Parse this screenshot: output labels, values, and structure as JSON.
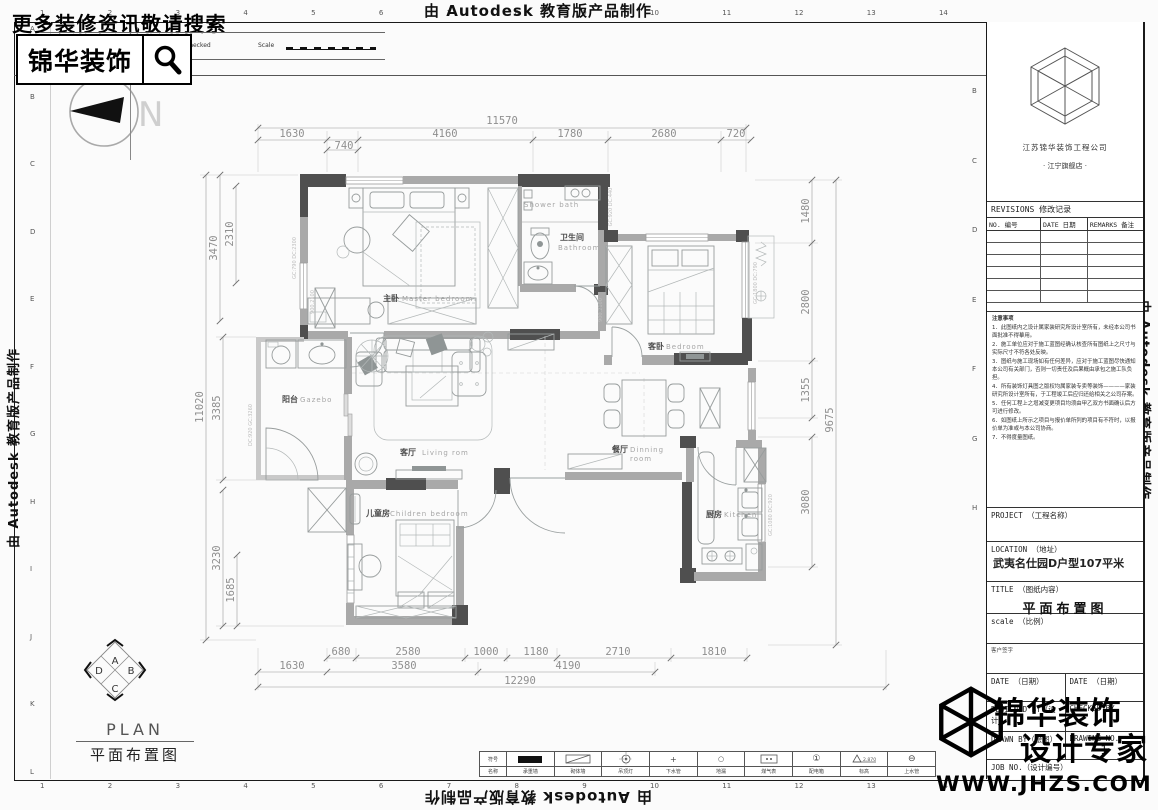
{
  "watermarks": {
    "top": "由 Autodesk 教育版产品制作",
    "bottom": "由 Autodesk 教育版产品制作",
    "left": "由 Autodesk 教育版产品制作",
    "right": "由 Autodesk 教育版产品制作"
  },
  "promo": {
    "search_hint": "更多装修资讯敬请搜索",
    "logo": "锦华装饰"
  },
  "frame_strip": {
    "rev_no": "Rev/No",
    "revision_note": "Revision note",
    "signature": "Signature",
    "checked": "Checked",
    "scale": "Scale"
  },
  "compass": {
    "north": "N"
  },
  "orientation": {
    "top": "A",
    "right": "B",
    "bottom": "C",
    "left": "D"
  },
  "plan_label": {
    "en": "PLAN",
    "zh": "平面布置图"
  },
  "ruler": {
    "top": [
      "1",
      "2",
      "3",
      "4",
      "5",
      "6",
      "7",
      "8",
      "9",
      "10",
      "11",
      "12",
      "13",
      "14"
    ],
    "bottom": [
      "1",
      "2",
      "3",
      "4",
      "5",
      "6",
      "7",
      "8",
      "9",
      "10",
      "11",
      "12",
      "13",
      "14"
    ],
    "left": [
      "A",
      "B",
      "C",
      "D",
      "E",
      "F",
      "G",
      "H",
      "I",
      "J",
      "K",
      "L"
    ],
    "right": [
      "B",
      "C",
      "D",
      "E",
      "F",
      "G",
      "H"
    ]
  },
  "rooms": {
    "master": {
      "zh": "主卧",
      "en": "Master bedroom"
    },
    "shower": {
      "en": "Shower bath"
    },
    "bathroom": {
      "zh": "卫生间",
      "en": "Bathroom"
    },
    "bedroom": {
      "zh": "客卧",
      "en": "Bedroom"
    },
    "balcony": {
      "zh": "阳台",
      "en": "Gazebo"
    },
    "living": {
      "zh": "客厅",
      "en": "Living rom"
    },
    "dining": {
      "zh": "餐厅",
      "en": "Dinning",
      "en2": "room"
    },
    "children": {
      "zh": "儿童房",
      "en": "Children bedroom"
    },
    "kitchen": {
      "zh": "厨房",
      "en": "Kitchen"
    }
  },
  "window_tags": [
    "GC:790 DC:2300",
    "DC:920 GC:3260",
    "GC:1800 DC:790",
    "GC:1080 DC:920",
    "GC:920 DC:440",
    "900.2100",
    "900.2100"
  ],
  "dims": {
    "top_total": "11570",
    "top": [
      "1630",
      "740",
      "4160",
      "1780",
      "2680",
      "720"
    ],
    "left": [
      "3470",
      "2310",
      "11020",
      "3385",
      "3230",
      "1685"
    ],
    "right": [
      "1480",
      "2800",
      "1355",
      "3080"
    ],
    "right_total": "9675",
    "bottom1": [
      "680",
      "2580",
      "1000",
      "1180",
      "2710",
      "1810"
    ],
    "bottom2": [
      "1630",
      "3580",
      "4190"
    ],
    "bottom_total": "12290"
  },
  "legend": {
    "col_sym": "符号",
    "col_name": "名称",
    "elev": "2.870",
    "items": [
      {
        "label": "承重墙"
      },
      {
        "label": "砌体墙"
      },
      {
        "label": "吊顶灯"
      },
      {
        "label": "下水管"
      },
      {
        "label": "地漏"
      },
      {
        "label": "煤气表"
      },
      {
        "label": "配电箱"
      },
      {
        "label": "标高"
      },
      {
        "label": "上水管"
      }
    ]
  },
  "titleblock": {
    "company": "江苏锦华装饰工程公司",
    "store": "·  江宁旗舰店  ·",
    "revisions_title": "REVISIONS 修改记录",
    "col_no": "NO. 编号",
    "col_date": "DATE 日期",
    "col_remarks": "REMARKS 备注",
    "notes_title": "注意事项",
    "notes": [
      "1．此图纸内之设计属家装研究所设计室所有，未经本公司书面批准不得摹用。",
      "2．施工单位应对于施工蓝图经确认核查所有图纸上之尺寸与实际尺寸不符各处反映。",
      "3．图纸与施工现场如有任何差异，应对于施工蓝图尽快通知本公司有关部门，否则一切责任及后果概由承包之施工队负担。",
      "4．所有装饰灯具图之版权均属家装专卖等装饰————家装研究所设计室所有，于工程竣工后应归还给相关之公司存案。",
      "5．任何工程上之增减变更项目均须由甲乙双方书面确认后方可进行修改。",
      "6．如图纸上所示之项目与报价单所列的项目有不符时，以报价单为准或与本公司协商。",
      "7．不得度量图纸。"
    ],
    "project_label": "PROJECT （工程名称）",
    "location_label": "LOCATION （地址）",
    "location_value": "武夷名仕园D户型107平米",
    "title_label": "TITLE （图纸内容）",
    "title_value": "平面布置图",
    "scale_label": "scale （比例）",
    "client_sign": "客户签字",
    "date_label_1": "DATE （日期）",
    "date_label_2": "DATE （日期）",
    "designed_by": "DESIGNED BY（设计）",
    "checked_by": "CHECKED BY",
    "drawn_by": "DRAWN BY（绘图）",
    "drawing_no": "DRAWING NO.",
    "drawing_no_value": "1",
    "job_no": "JOB NO.（设计编号）"
  },
  "brand": {
    "line1": "锦华装饰",
    "line2": "设计专家",
    "site": "WWW.JHZS.COM"
  }
}
